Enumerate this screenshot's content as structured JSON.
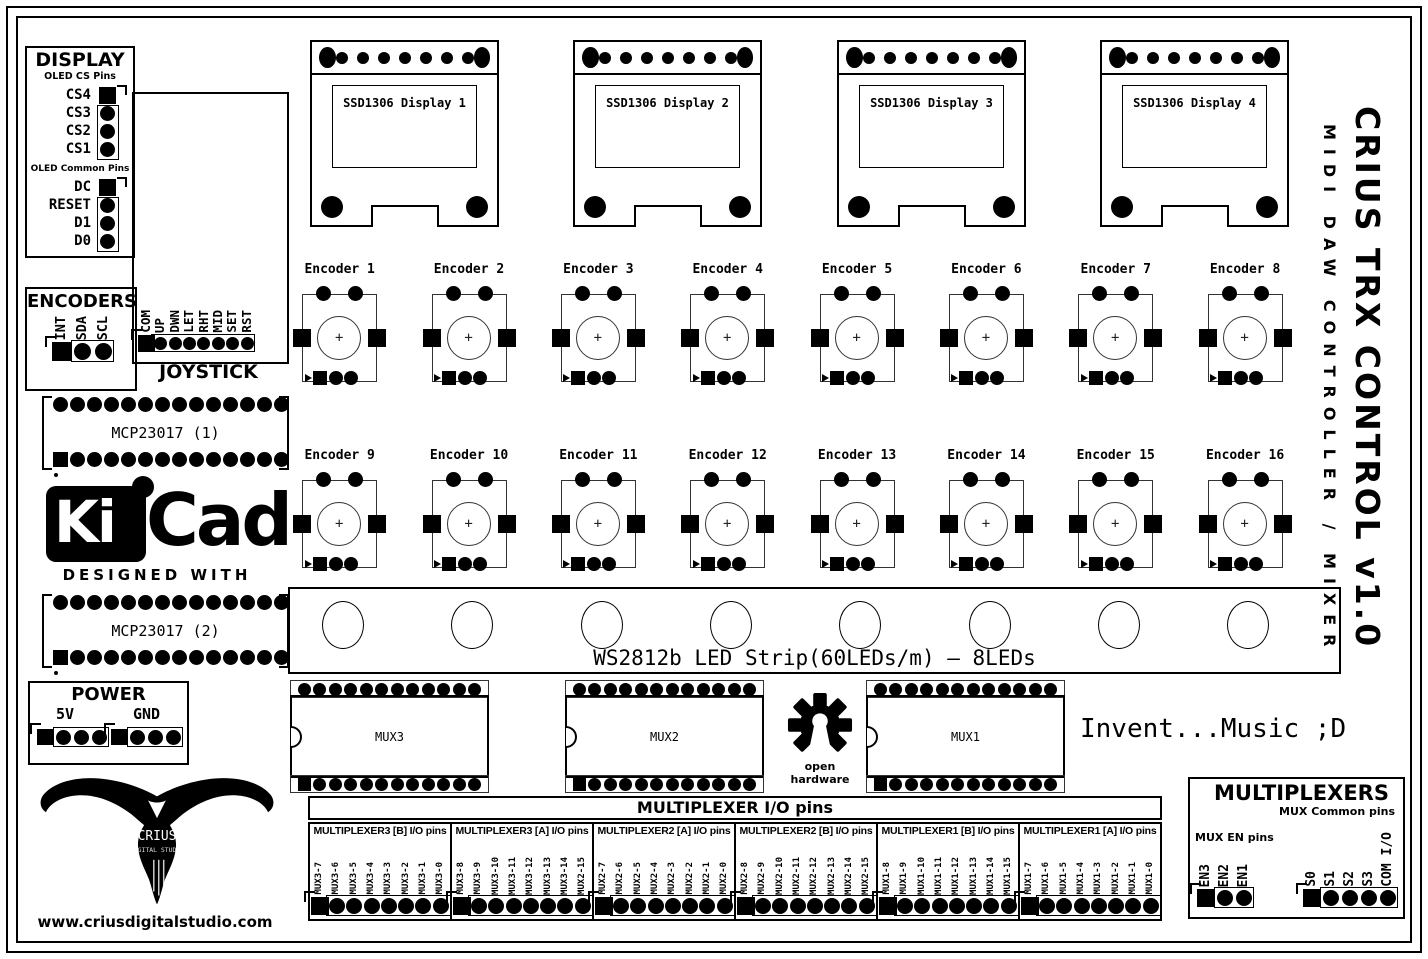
{
  "board": {
    "title": "CRIUS TRX CONTROL v1.0",
    "subtitle": "MIDI DAW CONTROLLER / MIXER",
    "slogan": "Invent...Music ;D",
    "website": "www.criusdigitalstudio.com",
    "open_hardware_label": "open hardware",
    "bull_logo_text": "CRIUS",
    "bull_logo_subtext": "DIGITAL STUDIO",
    "kicad_logo": {
      "ki": "Ki",
      "cad": "Cad",
      "tagline": "DESIGNED WITH"
    },
    "colors": {
      "silkscreen": "#000000",
      "background": "#ffffff"
    }
  },
  "display_section": {
    "title": "DISPLAY",
    "cs_header": "OLED CS Pins",
    "cs_pins": [
      "CS4",
      "CS3",
      "CS2",
      "CS1"
    ],
    "common_header": "OLED Common Pins",
    "common_pins": [
      "DC",
      "RESET",
      "D1",
      "D0"
    ]
  },
  "encoders_section": {
    "title": "ENCODERS",
    "pins": [
      "INT",
      "SDA",
      "SCL"
    ]
  },
  "joystick_section": {
    "title": "JOYSTICK",
    "pins": [
      "COM",
      "UP",
      "DWN",
      "LET",
      "RHT",
      "MID",
      "SET",
      "RST"
    ]
  },
  "oled_displays": {
    "labels": [
      "SSD1306 Display 1",
      "SSD1306 Display 2",
      "SSD1306 Display 3",
      "SSD1306 Display 4"
    ],
    "top_small_pin_count": 7
  },
  "encoders": {
    "labels": [
      "Encoder 1",
      "Encoder 2",
      "Encoder 3",
      "Encoder 4",
      "Encoder 5",
      "Encoder 6",
      "Encoder 7",
      "Encoder 8",
      "Encoder 9",
      "Encoder 10",
      "Encoder 11",
      "Encoder 12",
      "Encoder 13",
      "Encoder 14",
      "Encoder 15",
      "Encoder 16"
    ]
  },
  "mcp_expanders": {
    "labels": [
      "MCP23017 (1)",
      "MCP23017 (2)"
    ],
    "pins_per_row": 14
  },
  "led_strip": {
    "label": "WS2812b LED Strip(60LEDs/m) – 8LEDs",
    "led_count": 8
  },
  "mux_chips": {
    "labels": [
      "MUX3",
      "MUX2",
      "MUX1"
    ],
    "pins_per_row": 12
  },
  "power_section": {
    "title": "POWER",
    "rails": [
      "5V",
      "GND"
    ],
    "pins_per_rail": 4
  },
  "mux_io_section": {
    "header": "MULTIPLEXER I/O pins",
    "blocks": [
      {
        "title": "MULTIPLEXER3 [B] I/O pins",
        "pins": [
          "MUX3-7",
          "MUX3-6",
          "MUX3-5",
          "MUX3-4",
          "MUX3-3",
          "MUX3-2",
          "MUX3-1",
          "MUX3-0"
        ]
      },
      {
        "title": "MULTIPLEXER3 [A] I/O pins",
        "pins": [
          "MUX3-8",
          "MUX3-9",
          "MUX3-10",
          "MUX3-11",
          "MUX3-12",
          "MUX3-13",
          "MUX3-14",
          "MUX2-15"
        ]
      },
      {
        "title": "MULTIPLEXER2 [A] I/O pins",
        "pins": [
          "MUX2-7",
          "MUX2-6",
          "MUX2-5",
          "MUX2-4",
          "MUX2-3",
          "MUX2-2",
          "MUX2-1",
          "MUX2-0"
        ]
      },
      {
        "title": "MULTIPLEXER2 [B] I/O pins",
        "pins": [
          "MUX2-8",
          "MUX2-9",
          "MUX2-10",
          "MUX2-11",
          "MUX2-12",
          "MUX2-13",
          "MUX2-14",
          "MUX2-15"
        ]
      },
      {
        "title": "MULTIPLEXER1 [B] I/O pins",
        "pins": [
          "MUX1-8",
          "MUX1-9",
          "MUX1-10",
          "MUX1-11",
          "MUX1-12",
          "MUX1-13",
          "MUX1-14",
          "MUX1-15"
        ]
      },
      {
        "title": "MULTIPLEXER1 [A] I/O pins",
        "pins": [
          "MUX1-7",
          "MUX1-6",
          "MUX1-5",
          "MUX1-4",
          "MUX1-3",
          "MUX1-2",
          "MUX1-1",
          "MUX1-0"
        ]
      }
    ]
  },
  "multiplexers_section": {
    "title": "MULTIPLEXERS",
    "common_header": "MUX Common pins",
    "en_header": "MUX EN pins",
    "en_pins": [
      "EN3",
      "EN2",
      "EN1"
    ],
    "common_pins": [
      "S0",
      "S1",
      "S2",
      "S3",
      "COM I/O"
    ]
  }
}
